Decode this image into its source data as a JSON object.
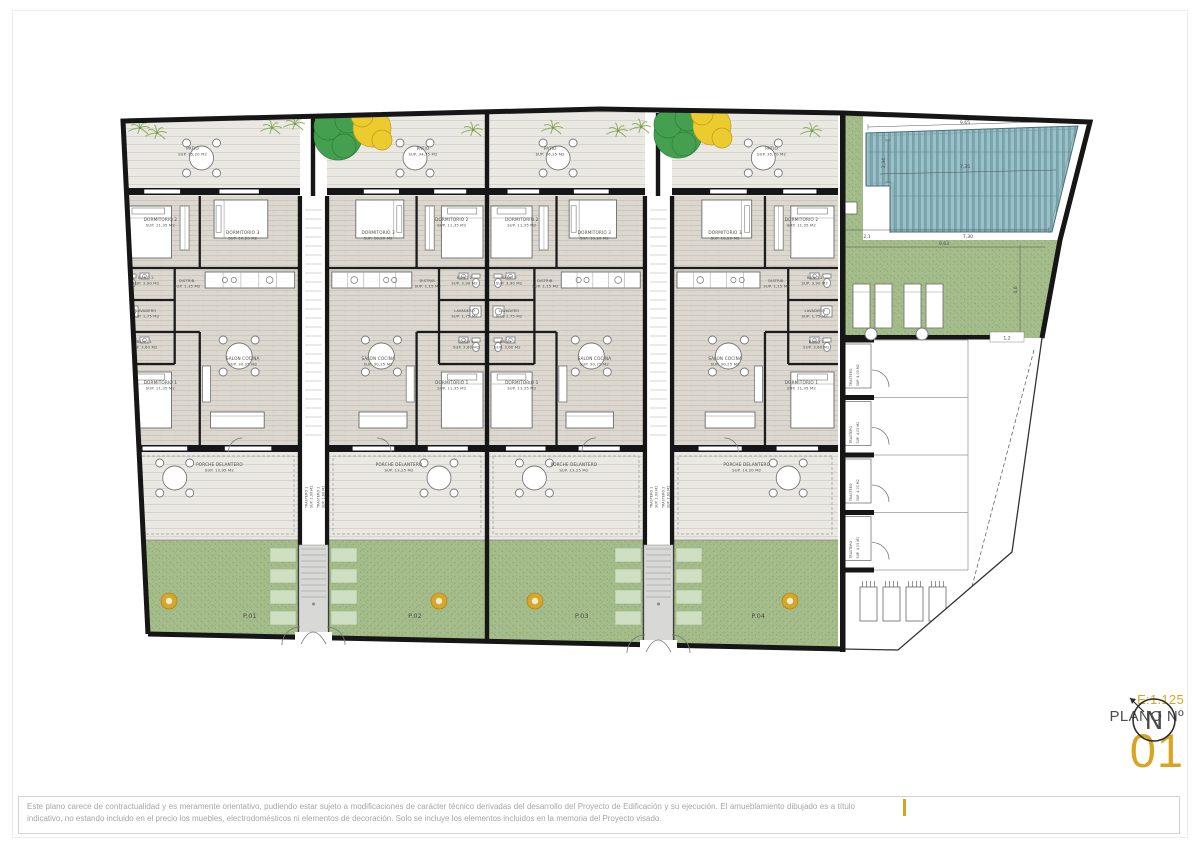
{
  "sheet": {
    "disclaimer": "Este plano carece de contractualidad y es meramente orientativo, pudiendo estar sujeto a modificaciones de carácter técnico derivadas del desarrollo del Proyecto de Edificación y su ejecución. El amueblamiento dibujado es a título indicativo, no estando incluido en el precio los muebles, electrodomésticos ni elementos de decoración. Solo se incluye los elementos incluidos en la memoria del Proyecto visado."
  },
  "titleblock": {
    "scale": "E:1.125",
    "plano_label": "PLANO Nº",
    "plano_number": "01",
    "north_letter": "N"
  },
  "rooms": {
    "patio": {
      "name": "PATIO"
    },
    "dorm2": {
      "name": "DORMITORIO 2",
      "sup": "SUP. 11,35 M2"
    },
    "dorm3": {
      "name": "DORMITORIO 3",
      "sup": "SUP. 10,20 M2"
    },
    "bano2": {
      "name": "BAÑO 2",
      "sup": "SUP. 3,90 M2"
    },
    "distrib": {
      "name": "DISTRIB.",
      "sup": "SUP. 1,15 M2"
    },
    "lavadero": {
      "name": "LAVADERO",
      "sup": "SUP. 1,75 M2"
    },
    "bano1": {
      "name": "BAÑO 1",
      "sup": "SUP. 3,60 M2"
    },
    "dorm1": {
      "name": "DORMITORIO 1",
      "sup": "SUP. 11,35 M2"
    },
    "salon": {
      "name": "SALON COCINA",
      "sup": "SUP. 30,25 M2"
    },
    "porche": {
      "name": "PORCHE DELANTERO"
    }
  },
  "units": [
    {
      "plot": "P.01",
      "patio_sup": "SUP. 35,20 M2",
      "porche_sup": "SUP. 13,95 M2"
    },
    {
      "plot": "P.02",
      "patio_sup": "SUP. 34,75 M2",
      "porche_sup": "SUP. 13,25 M2"
    },
    {
      "plot": "P.03",
      "patio_sup": "SUP. 36,25 M2",
      "porche_sup": "SUP. 13,25 M2"
    },
    {
      "plot": "P.04",
      "patio_sup": "SUP. 35,70 M2",
      "porche_sup": "SUP. 14,20 M2"
    }
  ],
  "strip": {
    "a_name": "TRASTERO 1",
    "a_sup": "SUP. 2,00 M2",
    "b_name": "TRASTERO 2",
    "b_sup": "SUP. 2,60 M2"
  },
  "parking": {
    "stalls": [
      "P.08",
      "P.07",
      "P.06",
      "P.05"
    ],
    "trastero_name": "TRASTERO",
    "trastero_sup": "SUP. 4,05 M2"
  },
  "dims": {
    "pool_top": "9,65",
    "pool_mid": "7,35",
    "pool_left": "2,34",
    "deck_left": "2,1",
    "pool_bottom": "7,30",
    "lawn_width": "9,63",
    "lawn_height": "4,6",
    "stall": "1,2"
  },
  "colors": {
    "gold": "#D9A521",
    "wall": "#161616",
    "lawn": "#A5BD8B",
    "pool": "#7BA8B1",
    "floor": "#DCD8CF",
    "patio": "#EAE8E3",
    "pads": "#CFE0C2"
  }
}
